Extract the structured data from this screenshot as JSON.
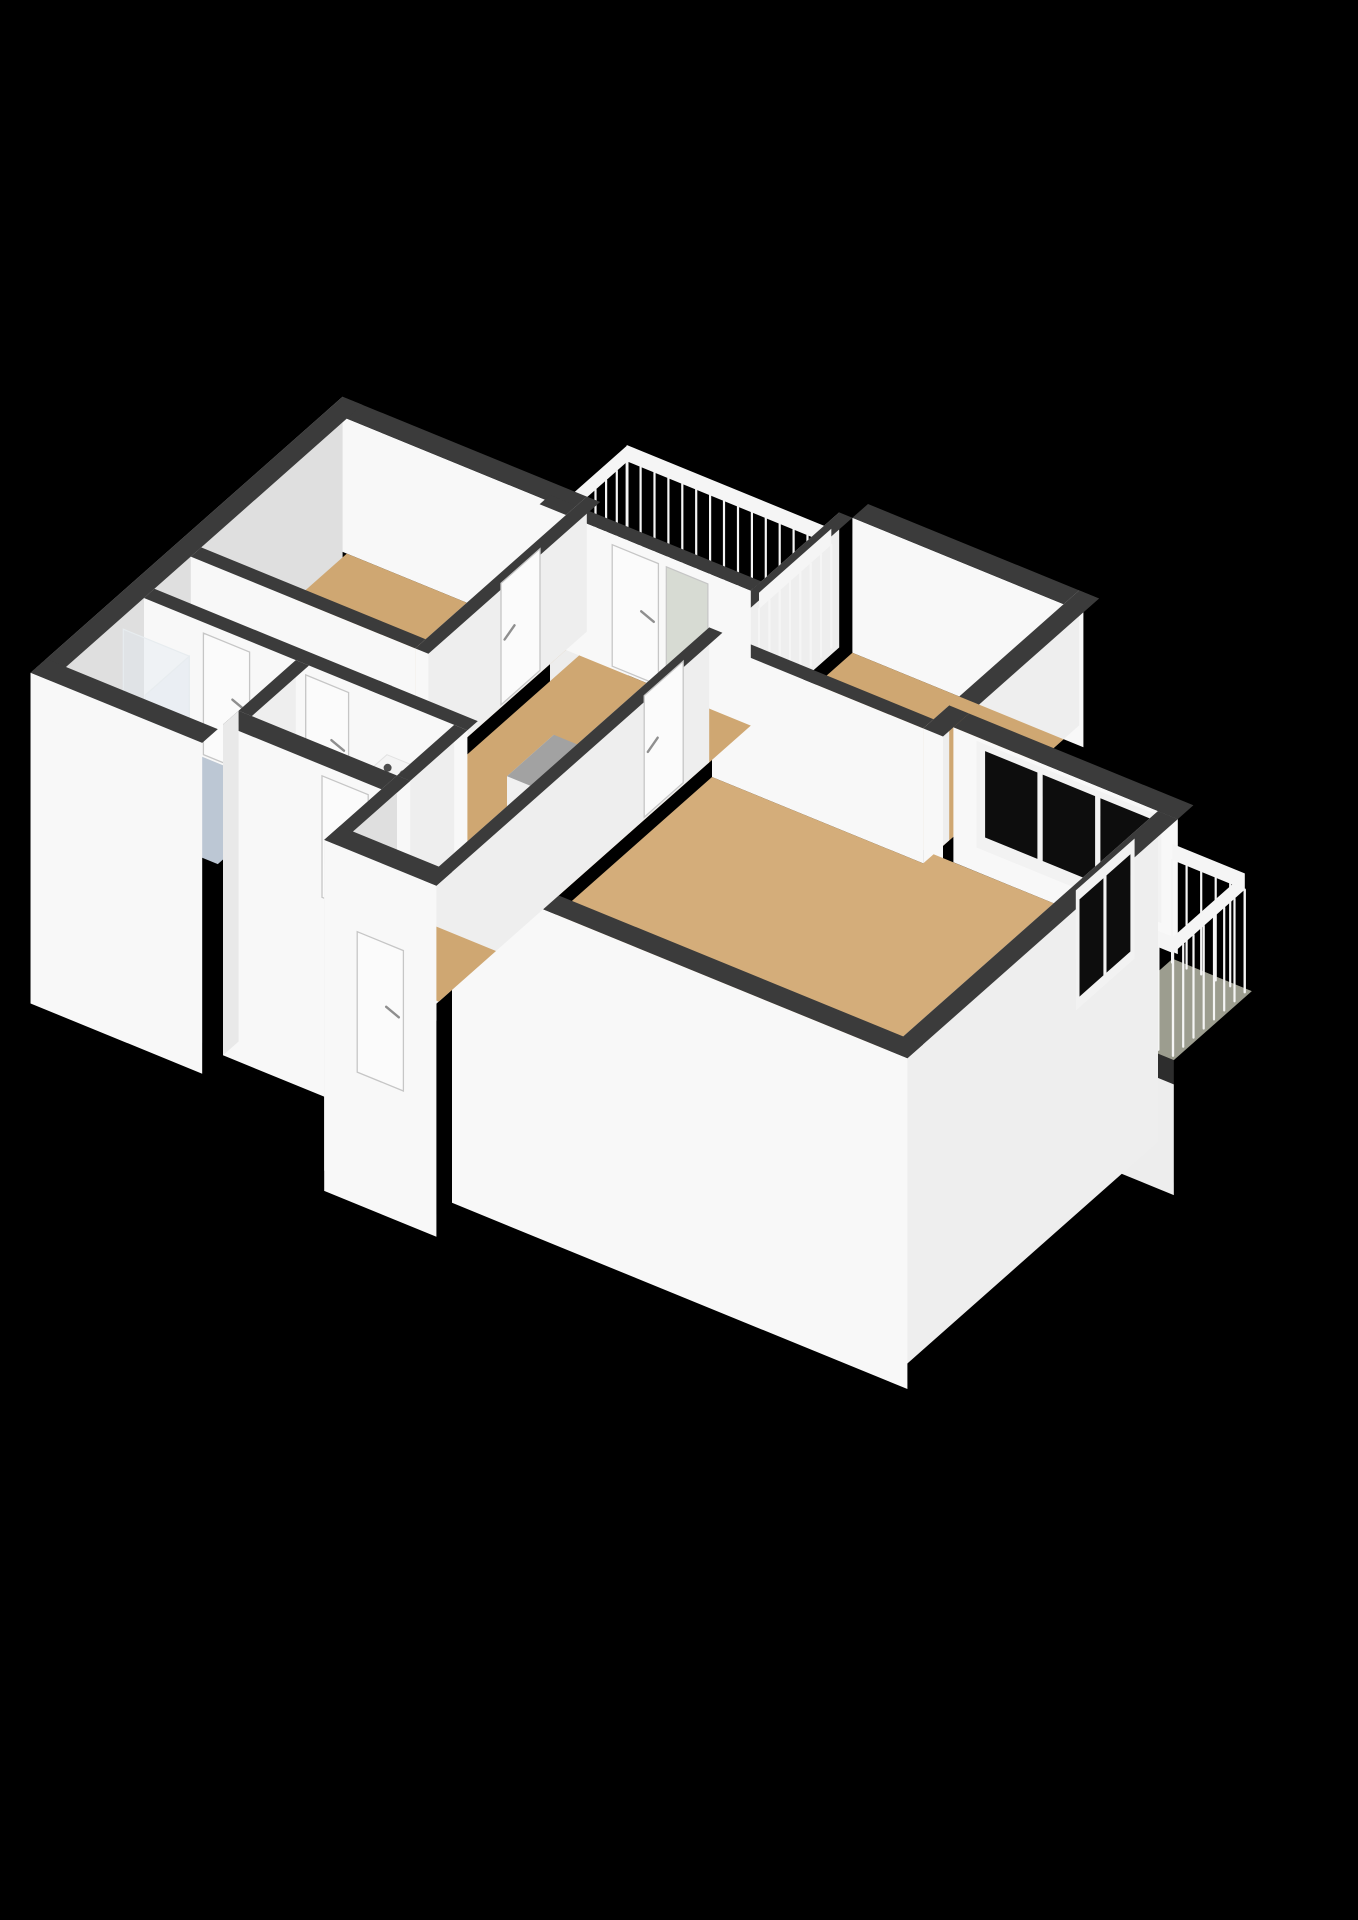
{
  "scene": {
    "title": "3D cutaway floor plan of an apartment",
    "style": "isometric 3D floor plan render with white cut walls, dark wall tops, on a black background",
    "background_color": "#000000",
    "visible_text": ""
  },
  "colors": {
    "background": "#000000",
    "wall_top": "#3b3b3b",
    "wall_face_bright": "#f8f8f8",
    "wall_face_side": "#eeeeee",
    "wall_face_exterior": "#dfdfdf",
    "slab_edge": "#2d2d2d",
    "slab_mass": "#ededed",
    "floor_wood": "#cfa772",
    "floor_wood_light": "#d4ad7a",
    "floor_balcony": "#9c9d8f",
    "floor_bathroom": "#bcc7d4",
    "floor_utility": "#e9e9e7",
    "shower_tray": "#d7dfe8",
    "window_glass": "#0d0d0d",
    "window_frame": "#f2f2f2",
    "door_leaf": "#fbfbfb",
    "door_frame": "#c6c6c6",
    "door_handle": "#8f8f8f",
    "railing": "#f5f5f5",
    "closet_top": "#a2a2a2",
    "closet_face_beige": "#dcc59f",
    "glass_panel": "#d7dbd3",
    "appliance_knob": "#4c4c4c",
    "appliance_slot": "#3f3f3f"
  },
  "rooms": [
    {
      "name": "living-room",
      "floor": "wood",
      "features": [
        "three-pane-window",
        "glass-door-to-east-balcony"
      ]
    },
    {
      "name": "bedroom-left",
      "floor": "wood",
      "features": [
        "door-to-hallway"
      ]
    },
    {
      "name": "bedroom-second",
      "floor": "wood",
      "features": [
        "door-to-hallway"
      ]
    },
    {
      "name": "hallway",
      "floor": "wood",
      "features": [
        "balcony-door",
        "sidelight",
        "closet-block"
      ]
    },
    {
      "name": "entrance-vestibule",
      "floor": "wood",
      "features": [
        "front-door"
      ]
    },
    {
      "name": "bathroom",
      "floor": "bathroom",
      "features": [
        "walk-in-shower",
        "glass-screen"
      ]
    },
    {
      "name": "toilet",
      "floor": "utility",
      "features": []
    },
    {
      "name": "laundry-closet",
      "floor": "utility",
      "features": [
        "washing-machine",
        "utility-sink"
      ]
    },
    {
      "name": "balcony-northwest",
      "floor": "balcony",
      "features": [
        "railing"
      ]
    },
    {
      "name": "balcony-east",
      "floor": "balcony",
      "features": [
        "railing"
      ]
    }
  ],
  "features": {
    "living_room_window": {
      "panes": 3
    },
    "balcony_east_door": {
      "glass_panes": 2
    },
    "washing_machine": {
      "knobs": 2
    },
    "balcony_northwest": {
      "railing_sides": 3
    },
    "balcony_east": {
      "railing_sides": 3
    },
    "doors": {
      "interior": 7,
      "front": 1
    }
  }
}
